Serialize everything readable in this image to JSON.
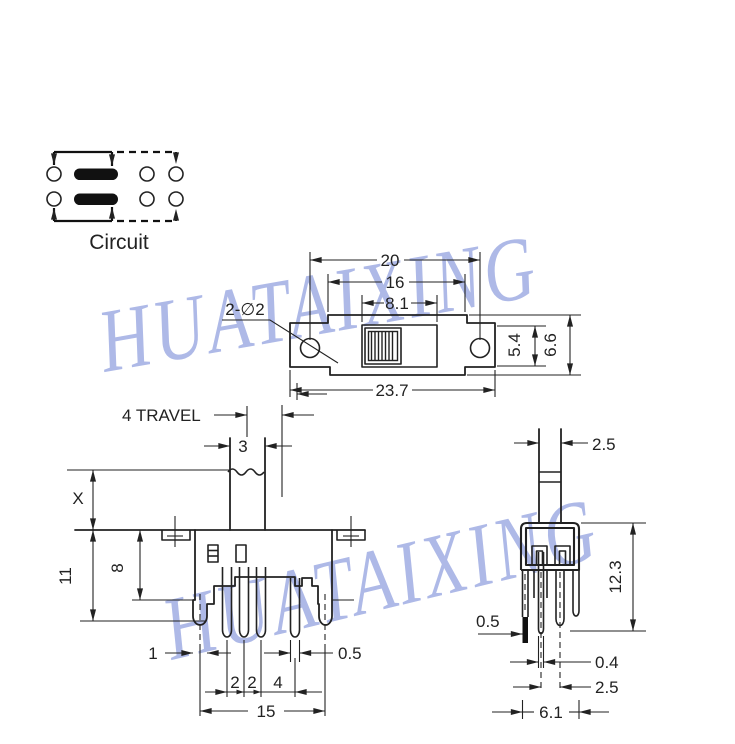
{
  "watermark": {
    "text": "HUATAIXING",
    "color": "#9aa8e2"
  },
  "circuit": {
    "label": "Circuit"
  },
  "top_view": {
    "hole_span": "20",
    "body_width": "16",
    "window_width": "8.1",
    "ear_depth": "5.4",
    "body_depth": "6.6",
    "overall_width": "23.7",
    "hole_note": "2-∅2"
  },
  "front_view": {
    "travel_label": "4 TRAVEL",
    "knob_width": "3",
    "height_x": "X",
    "height_total": "11",
    "height_body": "8",
    "bracket_width": "1",
    "pitch_a": "2",
    "pitch_b": "2",
    "pitch_c": "4",
    "pin_width": "0.5",
    "pin_span": "15"
  },
  "side_view": {
    "stem_width": "2.5",
    "body_height": "12.3",
    "tab_width": "0.5",
    "pin_thickness": "0.4",
    "pin_pitch": "2.5",
    "overall_depth": "6.1"
  }
}
